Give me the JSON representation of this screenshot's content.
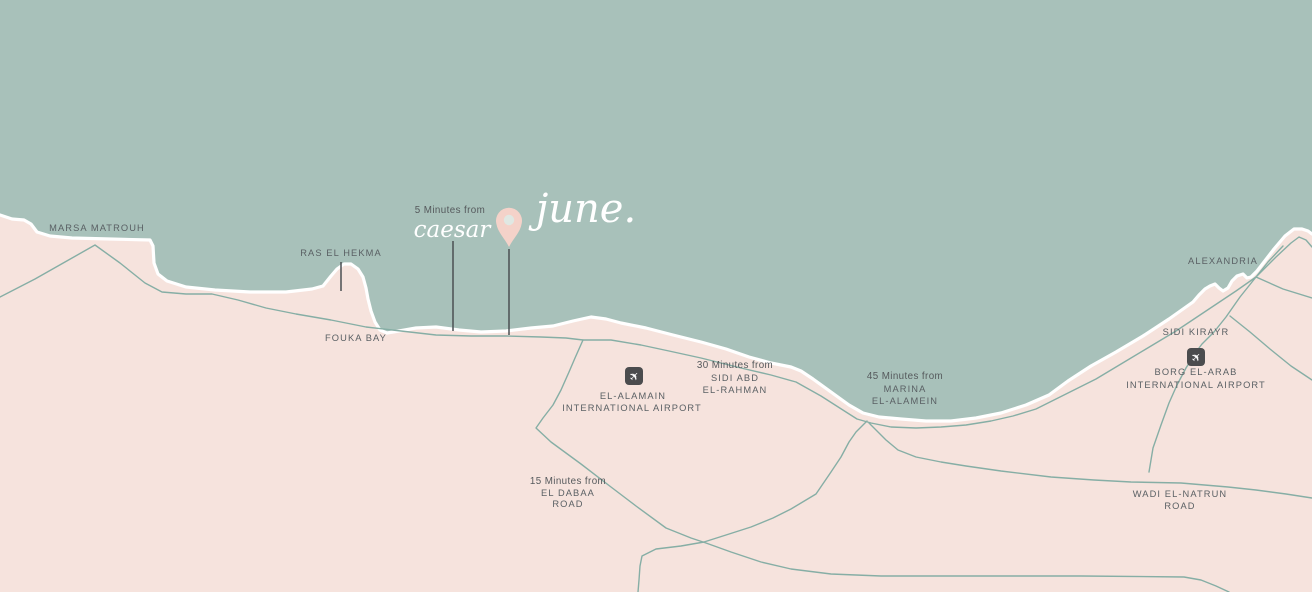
{
  "colors": {
    "sea": "#a8c1ba",
    "land": "#f6e3dd",
    "coast_stroke": "#ffffff",
    "road": "#86aea5",
    "label_text": "#5a6064",
    "script_text": "#ffffff",
    "pin": "#f4d2c9",
    "pin_hole": "#e0e8e3",
    "airport_icon_bg": "#4b4c4e",
    "airport_icon_glyph": "#ffffff",
    "pointer_line": "#4a4f52"
  },
  "icons": {
    "airplane_glyph": "✈"
  },
  "hero": {
    "distance_label": "5 Minutes from",
    "nearby_name": "caesar",
    "project_name": "june."
  },
  "places": {
    "marsa_matrouh": "MARSA MATROUH",
    "ras_el_hekma": "RAS EL HEKMA",
    "fouka_bay": "FOUKA BAY",
    "alexandria": "ALEXANDRIA",
    "sidi_kirayr": "SIDI KIRAYR"
  },
  "distance_notes": {
    "sidi_abd_el_rahman": {
      "line1": "30 Minutes from",
      "line2": "SIDI ABD",
      "line3": "EL-RAHMAN"
    },
    "marina_el_alamein": {
      "line1": "45 Minutes from",
      "line2": "MARINA",
      "line3": "EL-ALAMEIN"
    },
    "el_dabaa_road": {
      "line1": "15 Minutes from",
      "line2": "EL DABAA",
      "line3": "ROAD"
    }
  },
  "road_labels": {
    "wadi_el_natrun": {
      "line1": "WADI EL-NATRUN",
      "line2": "ROAD"
    }
  },
  "airports": {
    "el_alamain": {
      "line1": "EL-ALAMAIN",
      "line2": "INTERNATIONAL AIRPORT"
    },
    "borg_el_arab": {
      "line1": "BORG EL-ARAB",
      "line2": "INTERNATIONAL AIRPORT"
    }
  }
}
